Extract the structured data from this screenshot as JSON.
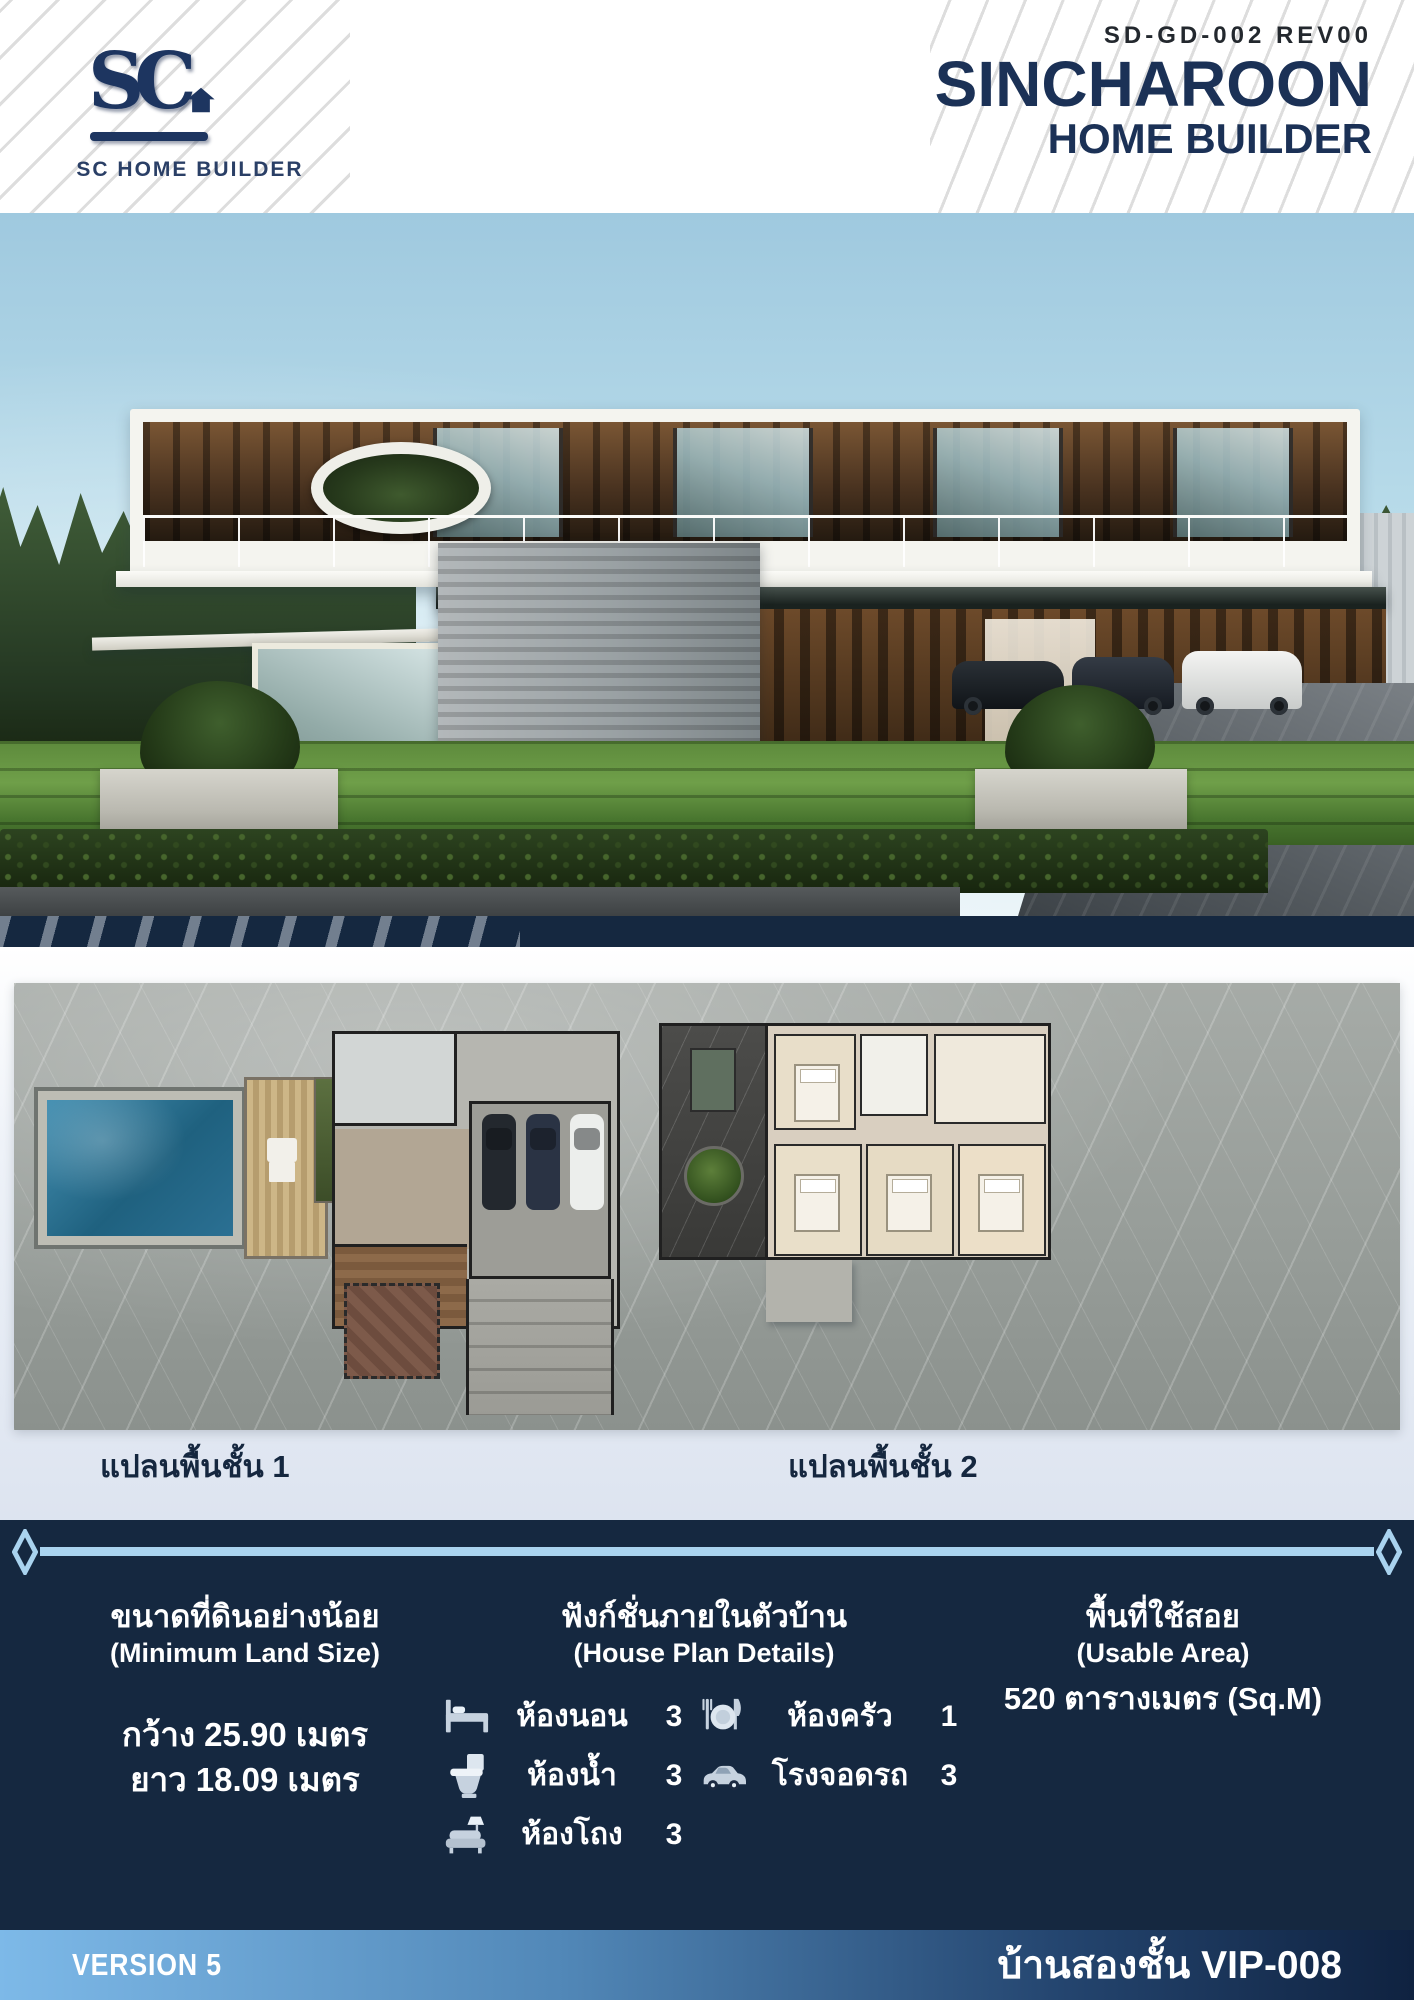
{
  "header": {
    "logo": {
      "monogram": "SC",
      "label": "SC HOME BUILDER"
    },
    "doc_code": "SD-GD-002 REV00",
    "brand_title": "SINCHAROON",
    "brand_subtitle": "HOME BUILDER"
  },
  "floor_plans": {
    "plan1_label": "แปลนพื้นชั้น 1",
    "plan2_label": "แปลนพื้นชั้น 2"
  },
  "specs": {
    "land": {
      "title_th": "ขนาดที่ดินอย่างน้อย",
      "title_en": "(Minimum Land Size)",
      "width": "กว้าง 25.90 เมตร",
      "length": "ยาว 18.09 เมตร"
    },
    "functions": {
      "title_th": "ฟังก์ชั่นภายในตัวบ้าน",
      "title_en": "(House Plan Details)",
      "items": [
        {
          "icon": "bed-icon",
          "label": "ห้องนอน",
          "value": "3"
        },
        {
          "icon": "kitchen-icon",
          "label": "ห้องครัว",
          "value": "1"
        },
        {
          "icon": "toilet-icon",
          "label": "ห้องน้ำ",
          "value": "3"
        },
        {
          "icon": "car-icon",
          "label": "โรงจอดรถ",
          "value": "3"
        },
        {
          "icon": "sofa-icon",
          "label": "ห้องโถง",
          "value": "3"
        }
      ]
    },
    "area": {
      "title_th": "พื้นที่ใช้สอย",
      "title_en": "(Usable Area)",
      "value": "520 ตารางเมตร (Sq.M)"
    }
  },
  "footer": {
    "version_label": "VERSION 5",
    "model_label": "บ้านสองชั้น VIP-008"
  },
  "colors": {
    "brand_navy": "#1b3156",
    "section_navy": "#152840",
    "accent_light_blue": "#a9d3ef",
    "footer_gradient_start": "#7db9e8",
    "footer_gradient_end": "#0f2240"
  }
}
